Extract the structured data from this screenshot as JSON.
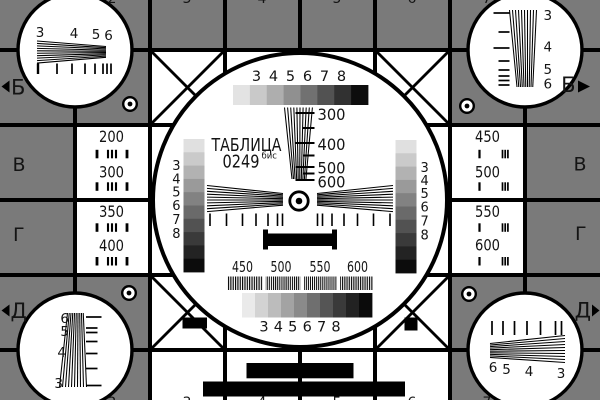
{
  "test_card": {
    "title": "ТАБЛИЦА",
    "number": "0249",
    "number_suffix": "бис",
    "colors": {
      "background_gray": "#7a7a7a",
      "card_white": "#ffffff",
      "line_black": "#000000",
      "text_black": "#141414"
    },
    "row_markers": {
      "left_b": "Б",
      "right_b": "Б",
      "left_v": "В",
      "right_v": "В",
      "left_g": "Г",
      "right_g": "Г",
      "left_d": "Д",
      "right_d": "Д"
    },
    "column_fragments_top": [
      "2",
      "3",
      "4",
      "5",
      "6",
      "7"
    ],
    "column_fragments_bottom": [
      "2",
      "3",
      "4",
      "5",
      "6",
      "7"
    ],
    "resolution_boxes": {
      "left_top": {
        "line1": "200",
        "line2": "300"
      },
      "left_bottom": {
        "line1": "350",
        "line2": "400"
      },
      "right_top": {
        "line1": "450",
        "line2": "500"
      },
      "right_bottom": {
        "line1": "550",
        "line2": "600"
      }
    },
    "corner_wedge_labels": {
      "top_left": [
        "3",
        "4",
        "5",
        "6"
      ],
      "top_right": [
        "3",
        "4",
        "5",
        "6"
      ],
      "bottom_left": [
        "6",
        "5",
        "4",
        "3"
      ],
      "bottom_right": [
        "6",
        "5",
        "4",
        "3"
      ]
    },
    "center": {
      "grayscale_top_labels": [
        "3",
        "4",
        "5",
        "6",
        "7",
        "8"
      ],
      "grayscale_bottom_labels": [
        "3",
        "4",
        "5",
        "6",
        "7",
        "8"
      ],
      "grayscale_left_labels": [
        "3",
        "4",
        "5",
        "6",
        "7",
        "8"
      ],
      "grayscale_right_labels": [
        "3",
        "4",
        "5",
        "6",
        "7",
        "8"
      ],
      "line_scale_labels": [
        "300",
        "400",
        "500",
        "600"
      ],
      "burst_labels": [
        "450",
        "500",
        "550",
        "600"
      ],
      "grayscale_top_steps": [
        "#e3e3e3",
        "#c9c9c9",
        "#aeaeae",
        "#909090",
        "#717171",
        "#525252",
        "#313131",
        "#0d0d0d"
      ],
      "grayscale_bottom_steps": [
        "#eaeaea",
        "#d3d3d3",
        "#bcbcbc",
        "#a3a3a3",
        "#8a8a8a",
        "#6f6f6f",
        "#555555",
        "#3a3a3a",
        "#222222",
        "#0b0b0b"
      ],
      "grayscale_side_steps": [
        "#e0e0e0",
        "#cacaca",
        "#b2b2b2",
        "#9a9a9a",
        "#828282",
        "#6a6a6a",
        "#525252",
        "#3a3a3a",
        "#232323",
        "#0c0c0c"
      ]
    }
  }
}
